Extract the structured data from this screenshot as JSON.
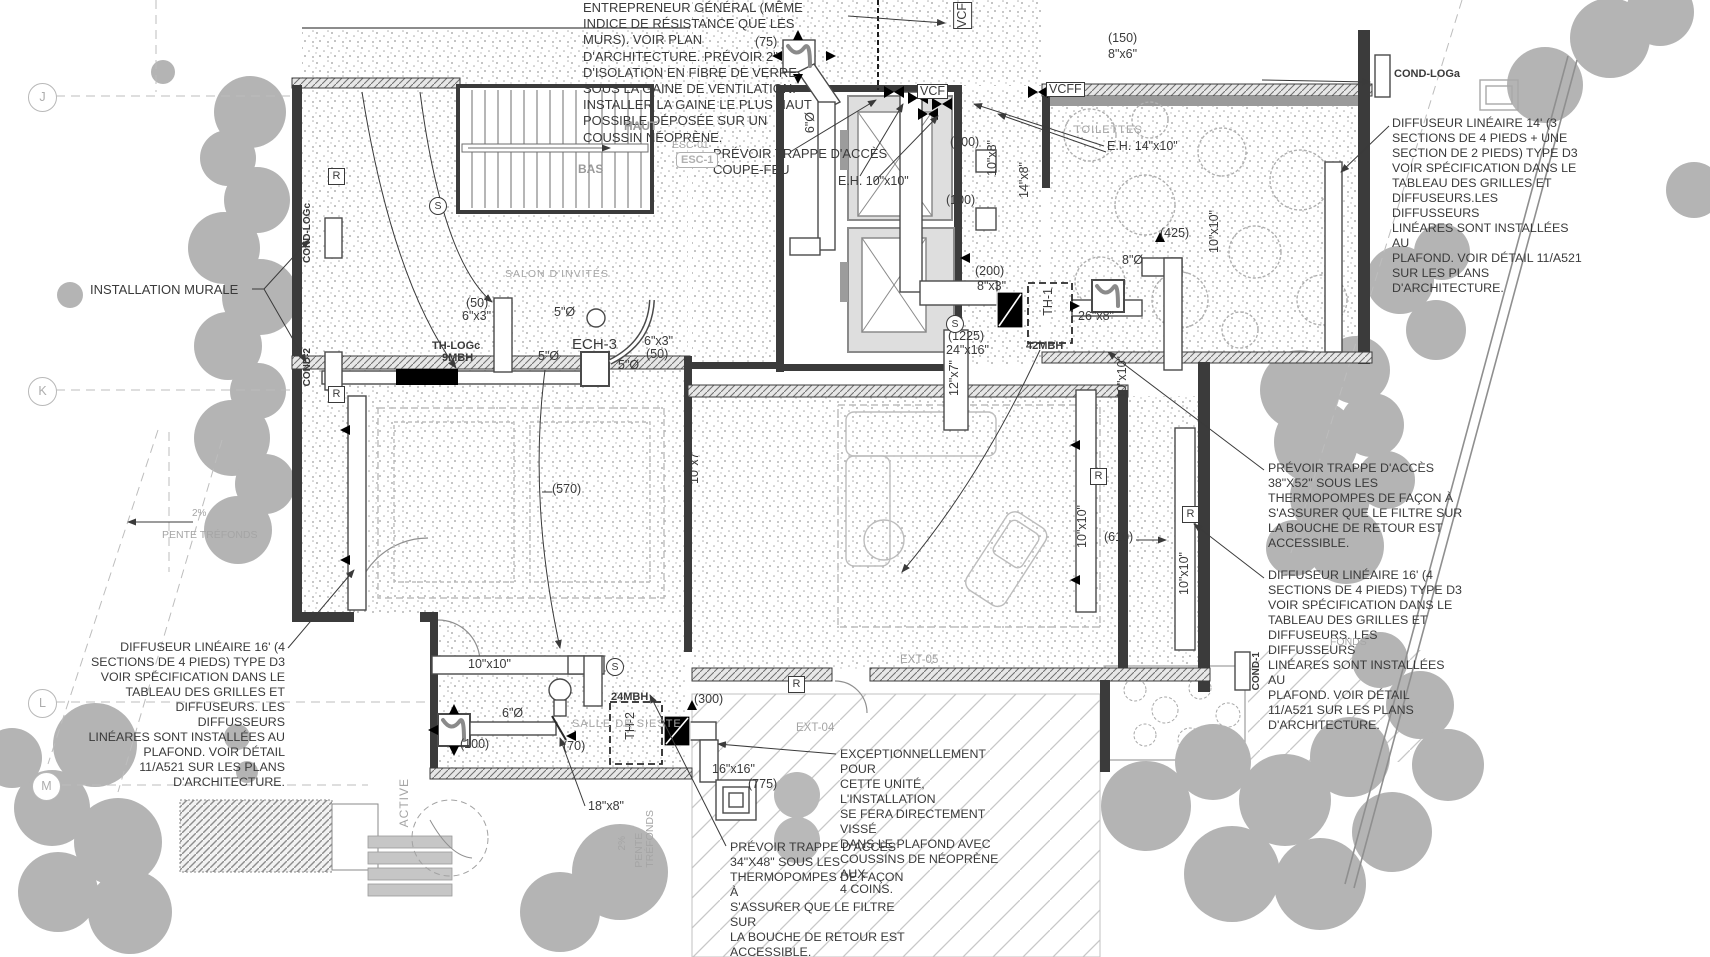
{
  "grid": {
    "j": "J",
    "k": "K",
    "l": "L",
    "m": "M"
  },
  "notes": {
    "installation_murale": "INSTALLATION MURALE",
    "entrepreneur": "ENTREPRENEUR GÉNÉRAL (MÊME\nINDICE DE RÉSISTANCE QUE LES\nMURS). VOIR PLAN\nD'ARCHITECTURE. PRÉVOIR 2\"\nD'ISOLATION EN FIBRE DE VERRE\nSOUS LA GAINE DE VENTILATION.\nINSTALLER LA GAINE LE PLUS HAUT\nPOSSIBLE DÉPOSÉE SUR UN\nCOUSSIN NÉOPRÈNE.",
    "trappe_coupe_feu": "PRÉVOIR TRAPPE D'ACCÈS\nCOUPE-FEU",
    "diffuseur_14": "DIFFUSEUR LINÉAIRE 14' (3\nSECTIONS DE 4 PIEDS + UNE\nSECTION DE 2 PIEDS) TYPE D3\nVOIR SPÉCIFICATION DANS LE\nTABLEAU DES GRILLES ET\nDIFFUSEURS.LES DIFFUSSEURS\nLINÉARES SONT INSTALLÉES AU\nPLAFOND. VOIR DÉTAIL 11/A521\nSUR LES PLANS D'ARCHITECTURE.",
    "trappe_38": "PRÉVOIR TRAPPE D'ACCÈS\n38\"X52\" SOUS LES\nTHERMOPOMPES DE FAÇON À\nS'ASSURER QUE LE FILTRE SUR\nLA BOUCHE DE RETOUR EST\nACCESSIBLE.",
    "diffuseur_16_droite": "DIFFUSEUR LINÉAIRE 16' (4\nSECTIONS DE 4 PIEDS) TYPE D3\nVOIR SPÉCIFICATION DANS LE\nTABLEAU DES GRILLES ET\nDIFFUSEURS. LES DIFFUSSEURS\nLINÉARES SONT INSTALLÉES AU\nPLAFOND. VOIR DÉTAIL\n11/A521 SUR LES PLANS\nD'ARCHITECTURE.",
    "diffuseur_16_gauche": "DIFFUSEUR LINÉAIRE 16' (4\nSECTIONS DE 4 PIEDS) TYPE D3\nVOIR SPÉCIFICATION DANS LE\nTABLEAU DES GRILLES ET\nDIFFUSEURS. LES DIFFUSSEURS\nLINÉARES SONT INSTALLÉES AU\nPLAFOND. VOIR DÉTAIL\n11/A521 SUR LES PLANS\nD'ARCHITECTURE.",
    "exceptionnellement": "EXCEPTIONNELLEMENT POUR\nCETTE UNITÉ, L'INSTALLATION\nSE FERA DIRECTEMENT VISSÉ\nDANS LE PLAFOND AVEC\nCOUSSINS DE NÉOPRÈNE AUX\n4 COINS.",
    "trappe_34": "PRÉVOIR TRAPPE D'ACCÈS\n34\"X48\" SOUS LES\nTHERMOPOMPES DE FAÇON À\nS'ASSURER QUE LE FILTRE SUR\nLA BOUCHE DE RETOUR EST\nACCESSIBLE."
  },
  "equipment": {
    "th1": "TH-1",
    "th1_capacity": "42MBH",
    "th2": "TH-2",
    "th2_capacity": "24MBH",
    "th_logc": "TH-LOGc",
    "th_logc_capacity": "9MBH",
    "ech3": "ECH-3",
    "cond_loga": "COND-LOGa",
    "cond_logc": "COND-LOGc",
    "cond_1": "COND-1",
    "cond_2": "COND-2",
    "eh_10": "E.H. 10\"x10\"",
    "eh_14": "E.H. 14\"x10\"",
    "vcf": "VCF",
    "vcff": "VCFF"
  },
  "ducts": {
    "d5": "5\"Ø",
    "d6": "6\"Ø",
    "d8": "8\"Ø",
    "d6x3": "6\"x3\"",
    "d8x3": "8\"x3\"",
    "d8x6": "8\"x6\"",
    "d10x7": "10\"x7\"",
    "d10x8": "10\"x8\"",
    "d10x10": "10\"x10\"",
    "d12x7": "12\"x7\"",
    "d14x8": "14\"x8\"",
    "d16x16": "16\"x16\"",
    "d18x8": "18\"x8\"",
    "d24x16": "24\"x16\"",
    "d26x8": "26\"x8\""
  },
  "airflows": {
    "a50": "(50)",
    "a70": "(70)",
    "a75": "(75)",
    "a100": "(100)",
    "a150": "(150)",
    "a200": "(200)",
    "a300": "(300)",
    "a425": "(425)",
    "a570": "(570)",
    "a610": "(610)",
    "a775": "(775)",
    "a1225": "(1225)"
  },
  "symbols": {
    "r": "R",
    "s": "S"
  },
  "rooms": {
    "toilettes": "TOILETTES",
    "salon": "SALON D'INVITÉS",
    "salle": "SALLE DE SIESTE",
    "esc": "ESC-01",
    "esc_tag": "ESC-1",
    "haut": "HAUT",
    "bas": "BAS",
    "ext04": "EXT-04",
    "ext05": "EXT-05"
  },
  "site": {
    "pente": "PENTE TRÉFONDS",
    "pente_v": "PENTE\nTRÉFONDS",
    "pct": "2%",
    "active": "ACTIVE",
    "fonds": "FONDS"
  },
  "colors": {
    "wall": "#3b3b3b",
    "tree": "#b4b4b4",
    "annotation": "#3a3a3a",
    "faint": "#a5a5a5"
  }
}
